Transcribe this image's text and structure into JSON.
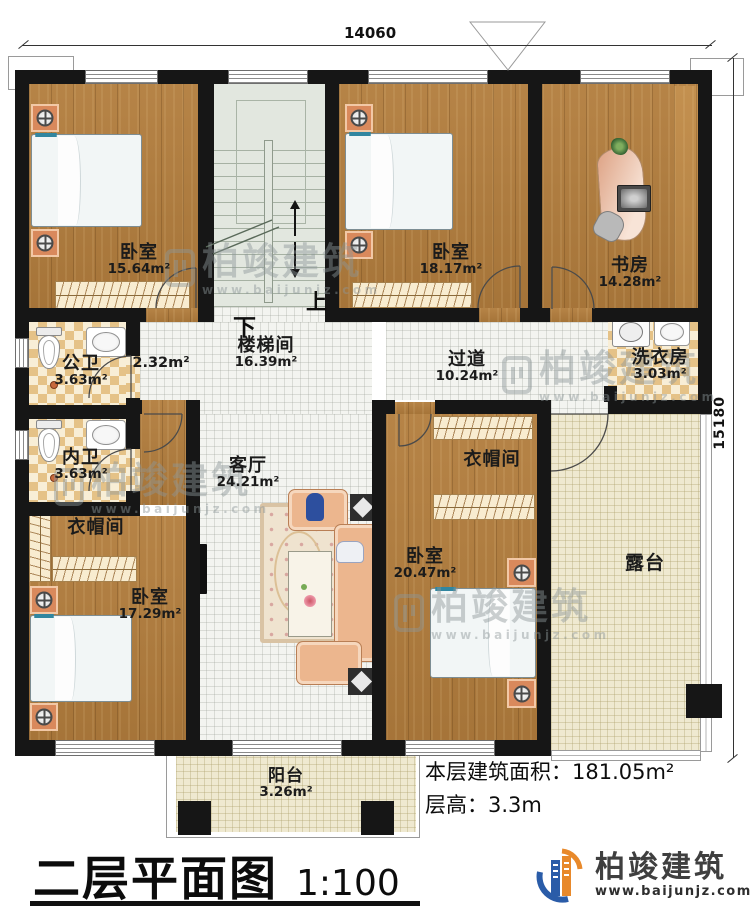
{
  "dimensions": {
    "top": "14060",
    "right": "15180"
  },
  "rooms": {
    "bedroom_tl": {
      "name": "卧室",
      "area": "15.64m²"
    },
    "stairwell": {
      "name": "楼梯间",
      "area": "16.39m²"
    },
    "bedroom_tm": {
      "name": "卧室",
      "area": "18.17m²"
    },
    "study": {
      "name": "书房",
      "area": "14.28m²"
    },
    "public_bath": {
      "name": "公卫",
      "area": "3.63m²"
    },
    "vestibule": {
      "area": "2.32m²"
    },
    "corridor": {
      "name": "过道",
      "area": "10.24m²"
    },
    "laundry": {
      "name": "洗衣房",
      "area": "3.03m²"
    },
    "private_bath": {
      "name": "内卫",
      "area": "3.63m²"
    },
    "living": {
      "name": "客厅",
      "area": "24.21m²"
    },
    "cloak_left": {
      "name": "衣帽间"
    },
    "cloak_right": {
      "name": "衣帽间"
    },
    "bedroom_bl": {
      "name": "卧室",
      "area": "17.29m²"
    },
    "bedroom_bm": {
      "name": "卧室",
      "area": "20.47m²"
    },
    "terrace": {
      "name": "露台"
    },
    "balcony": {
      "name": "阳台",
      "area": "3.26m²"
    }
  },
  "stairs": {
    "up": "上",
    "down": "下"
  },
  "footer": {
    "area_label": "本层建筑面积：",
    "area_value": "181.05m²",
    "floor_height_label": "层高：",
    "floor_height_value": "3.3m"
  },
  "title": {
    "text": "二层平面图",
    "scale": "1:100"
  },
  "brand": {
    "name": "柏竣建筑",
    "url": "www.baijunjz.com"
  },
  "watermark": {
    "name": "柏竣建筑",
    "url": "www.baijunjz.com"
  },
  "colors": {
    "wall": "#161616",
    "wood": "#b27d3d",
    "bed": "#74c4dc",
    "accent_orange": "#e8892b",
    "accent_blue": "#2a5ca8"
  }
}
